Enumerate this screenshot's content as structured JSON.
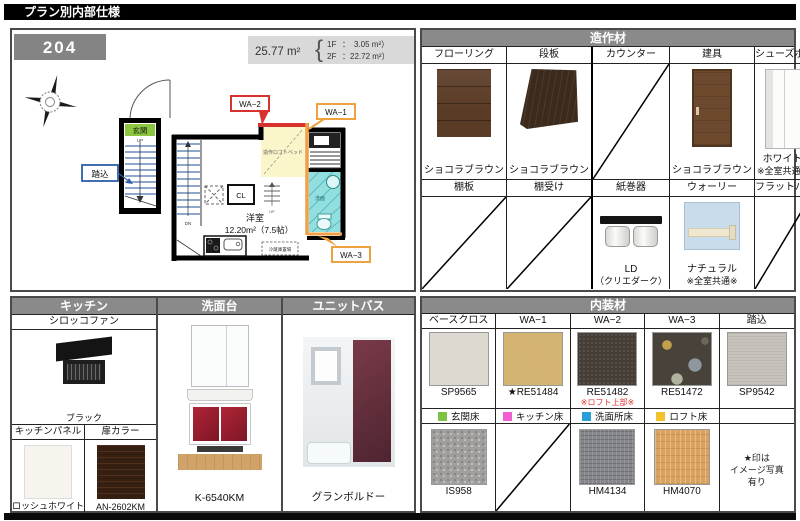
{
  "title": "プラン別内部仕様",
  "plan": {
    "room_number": "204",
    "area_total": "25.77 m²",
    "area_brace": "{",
    "area_rows": [
      {
        "label": "1F",
        "sep": "：",
        "value": "3.05 m²）"
      },
      {
        "label": "2F",
        "sep": "：",
        "value": "22.72 m²）"
      }
    ],
    "labels": {
      "genkan": "玄関",
      "up": "UP",
      "dn": "DN",
      "fumikomi": "踏込",
      "cl": "CL",
      "room_name": "洋室",
      "room_area": "12.20m²（7.5帖）",
      "loft_bed": "造作ロフトベッド",
      "senmen": "洗面",
      "fridge": "冷蔵庫置場",
      "wa1": "WA−1",
      "wa2": "WA−2",
      "wa3": "WA−3"
    }
  },
  "zosaku": {
    "title": "造作材",
    "row1": [
      {
        "name": "フローリング",
        "value": "ショコラブラウン"
      },
      {
        "name": "段板",
        "value": "ショコラブラウン"
      },
      {
        "name": "カウンター",
        "value": ""
      },
      {
        "name": "建具",
        "value": "ショコラブラウン"
      },
      {
        "name": "シューズボックス",
        "value": "ホワイト",
        "note": "※全室共通※"
      }
    ],
    "row2": [
      {
        "name": "棚板",
        "value": ""
      },
      {
        "name": "棚受け",
        "value": ""
      },
      {
        "name": "紙巻器",
        "value": "LD",
        "note": "（クリエダーク）"
      },
      {
        "name": "ウォーリー",
        "value": "ナチュラル",
        "note": "※全室共通※"
      },
      {
        "name": "フラットバー",
        "value": ""
      }
    ]
  },
  "kitchen": {
    "title": "キッチン",
    "fan_label": "シロッコファン",
    "fan_value": "ブラック",
    "panel_label": "キッチンパネル",
    "panel_value": "ロッシュホワイト",
    "door_label": "扉カラー",
    "door_value": "AN-2602KM"
  },
  "vanity": {
    "title": "洗面台",
    "value": "K-6540KM"
  },
  "bath": {
    "title": "ユニットバス",
    "value": "グランボルドー"
  },
  "naiso": {
    "title": "内装材",
    "columns": [
      {
        "name": "ベースクロス",
        "code": "SP9565",
        "note": "",
        "legend": "玄関床",
        "legend_color": "#7dc242",
        "floor_code": "IS958"
      },
      {
        "name": "WA−1",
        "code": "★RE51484",
        "note": "",
        "legend": "キッチン床",
        "legend_color": "#f25fd0",
        "floor_code": ""
      },
      {
        "name": "WA−2",
        "code": "RE51482",
        "note": "※ロフト上部※",
        "legend": "洗面所床",
        "legend_color": "#2b9fd8",
        "floor_code": "HM4134"
      },
      {
        "name": "WA−3",
        "code": "RE51472",
        "note": "",
        "legend": "ロフト床",
        "legend_color": "#f2c22e",
        "floor_code": "HM4070"
      },
      {
        "name": "踏込",
        "code": "SP9542",
        "note": "",
        "legend": "",
        "legend_color": "",
        "floor_code": ""
      }
    ],
    "footnote": [
      "★印は",
      "イメージ写真",
      "有り"
    ]
  }
}
